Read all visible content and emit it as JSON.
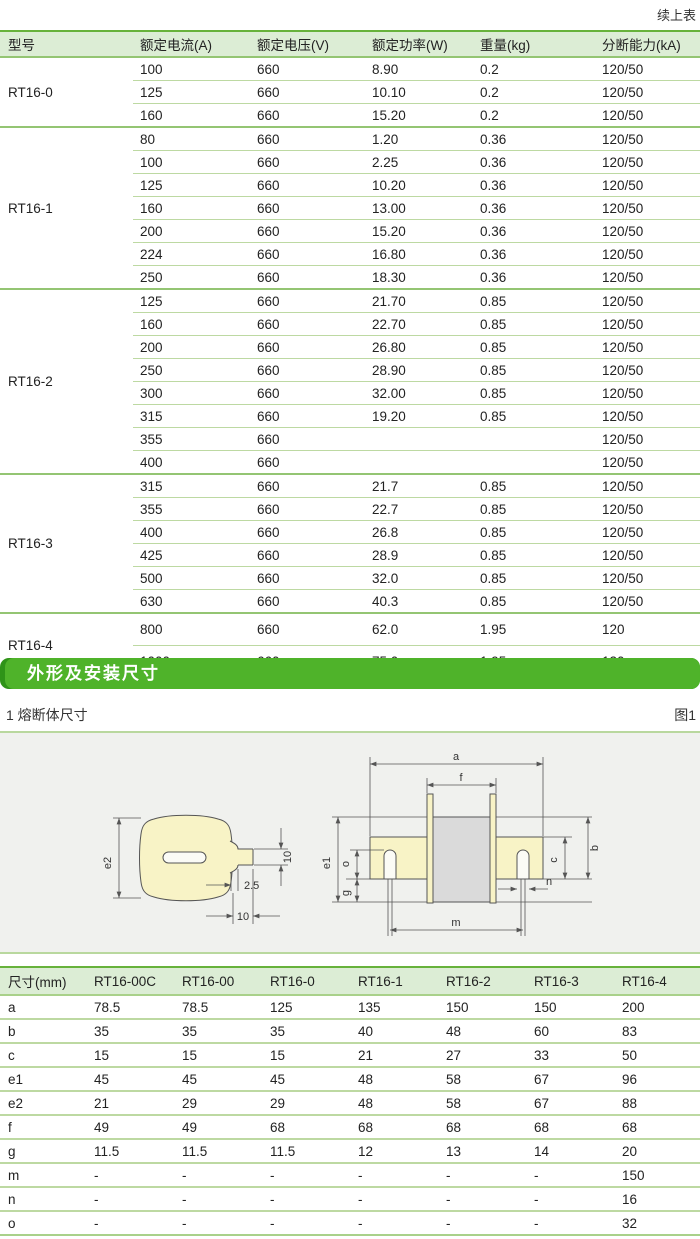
{
  "page": {
    "continued_note": "续上表"
  },
  "colors": {
    "accent_green": "#4fb32a",
    "accent_green_dark": "#2f9318",
    "header_bg": "#dcedd5",
    "line_light": "#bdd9a2",
    "line_medium": "#94c573",
    "drawing_bg": "#f0f1ee",
    "fuse_blade_yellow": "#f8f3c6",
    "fuse_body_gray": "#dadada"
  },
  "spec_table": {
    "headers": [
      "型号",
      "额定电流(A)",
      "额定电压(V)",
      "额定功率(W)",
      "重量(kg)",
      "分断能力(kA)"
    ],
    "groups": [
      {
        "model": "RT16-0",
        "rows": [
          [
            "100",
            "660",
            "8.90",
            "0.2",
            "120/50"
          ],
          [
            "125",
            "660",
            "10.10",
            "0.2",
            "120/50"
          ],
          [
            "160",
            "660",
            "15.20",
            "0.2",
            "120/50"
          ]
        ]
      },
      {
        "model": "RT16-1",
        "rows": [
          [
            "80",
            "660",
            "1.20",
            "0.36",
            "120/50"
          ],
          [
            "100",
            "660",
            "2.25",
            "0.36",
            "120/50"
          ],
          [
            "125",
            "660",
            "10.20",
            "0.36",
            "120/50"
          ],
          [
            "160",
            "660",
            "13.00",
            "0.36",
            "120/50"
          ],
          [
            "200",
            "660",
            "15.20",
            "0.36",
            "120/50"
          ],
          [
            "224",
            "660",
            "16.80",
            "0.36",
            "120/50"
          ],
          [
            "250",
            "660",
            "18.30",
            "0.36",
            "120/50"
          ]
        ]
      },
      {
        "model": "RT16-2",
        "rows": [
          [
            "125",
            "660",
            "21.70",
            "0.85",
            "120/50"
          ],
          [
            "160",
            "660",
            "22.70",
            "0.85",
            "120/50"
          ],
          [
            "200",
            "660",
            "26.80",
            "0.85",
            "120/50"
          ],
          [
            "250",
            "660",
            "28.90",
            "0.85",
            "120/50"
          ],
          [
            "300",
            "660",
            "32.00",
            "0.85",
            "120/50"
          ],
          [
            "315",
            "660",
            "19.20",
            "0.85",
            "120/50"
          ],
          [
            "355",
            "660",
            "",
            "",
            "120/50"
          ],
          [
            "400",
            "660",
            "",
            "",
            "120/50"
          ]
        ]
      },
      {
        "model": "RT16-3",
        "rows": [
          [
            "315",
            "660",
            "21.7",
            "0.85",
            "120/50"
          ],
          [
            "355",
            "660",
            "22.7",
            "0.85",
            "120/50"
          ],
          [
            "400",
            "660",
            "26.8",
            "0.85",
            "120/50"
          ],
          [
            "425",
            "660",
            "28.9",
            "0.85",
            "120/50"
          ],
          [
            "500",
            "660",
            "32.0",
            "0.85",
            "120/50"
          ],
          [
            "630",
            "660",
            "40.3",
            "0.85",
            "120/50"
          ]
        ]
      },
      {
        "model": "RT16-4",
        "tall": true,
        "rows": [
          [
            "800",
            "660",
            "62.0",
            "1.95",
            "120"
          ],
          [
            "1000",
            "660",
            "75.0",
            "1.95",
            "120"
          ]
        ]
      }
    ]
  },
  "section": {
    "title": "外形及安装尺寸"
  },
  "figure": {
    "caption": "1 熔断体尺寸",
    "ref": "图1",
    "dims": {
      "e2": "e2",
      "d10a": "10",
      "d25": "2.5",
      "d10b": "10",
      "a": "a",
      "f": "f",
      "e1": "e1",
      "o": "o",
      "g": "g",
      "b": "b",
      "c": "c",
      "n": "n",
      "m": "m"
    }
  },
  "dim_table": {
    "headers": [
      "尺寸(mm)",
      "RT16-00C",
      "RT16-00",
      "RT16-0",
      "RT16-1",
      "RT16-2",
      "RT16-3",
      "RT16-4"
    ],
    "rows": [
      [
        "a",
        "78.5",
        "78.5",
        "125",
        "135",
        "150",
        "150",
        "200"
      ],
      [
        "b",
        "35",
        "35",
        "35",
        "40",
        "48",
        "60",
        "83"
      ],
      [
        "c",
        "15",
        "15",
        "15",
        "21",
        "27",
        "33",
        "50"
      ],
      [
        "e1",
        "45",
        "45",
        "45",
        "48",
        "58",
        "67",
        "96"
      ],
      [
        "e2",
        "21",
        "29",
        "29",
        "48",
        "58",
        "67",
        "88"
      ],
      [
        "f",
        "49",
        "49",
        "68",
        "68",
        "68",
        "68",
        "68"
      ],
      [
        "g",
        "11.5",
        "11.5",
        "11.5",
        "12",
        "13",
        "14",
        "20"
      ],
      [
        "m",
        "-",
        "-",
        "-",
        "-",
        "-",
        "-",
        "150"
      ],
      [
        "n",
        "-",
        "-",
        "-",
        "-",
        "-",
        "-",
        "16"
      ],
      [
        "o",
        "-",
        "-",
        "-",
        "-",
        "-",
        "-",
        "32"
      ]
    ]
  }
}
